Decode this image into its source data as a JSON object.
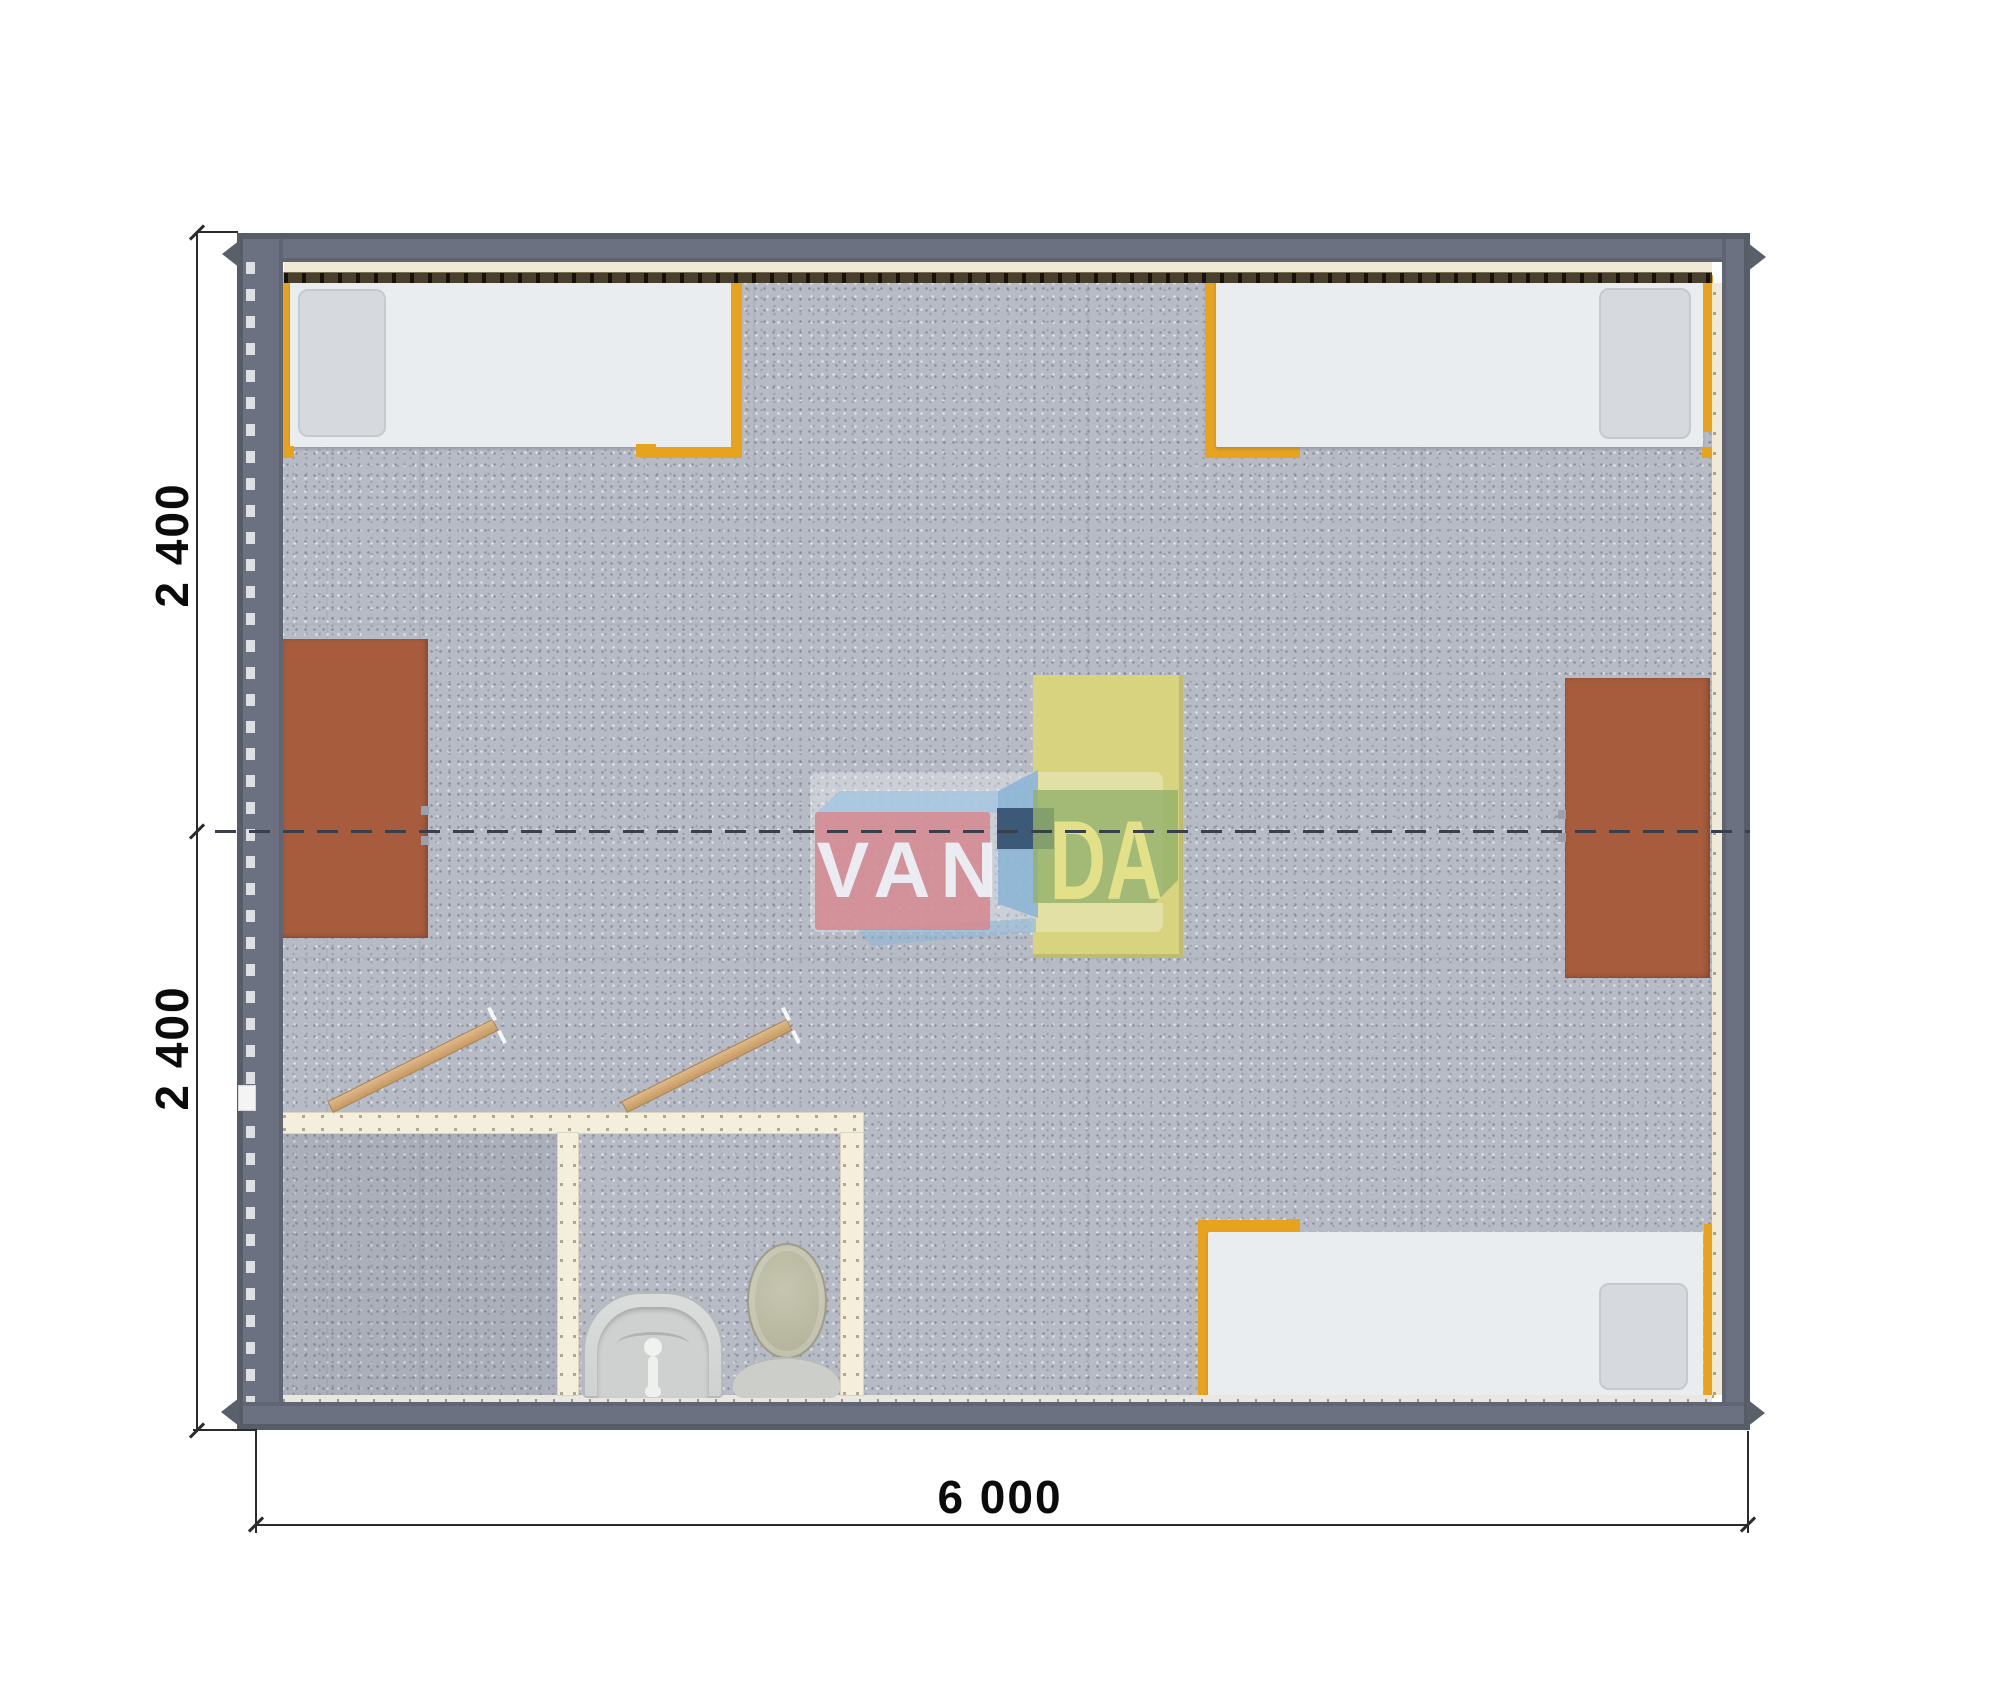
{
  "dimensions": {
    "left_top": "2 400",
    "left_bottom": "2 400",
    "bottom": "6 000",
    "building_width_mm": 6000,
    "module_depth_mm": 2400
  },
  "watermark": {
    "van": "VAN",
    "da": "DA"
  },
  "palette": {
    "wall_gray": "#6b7180",
    "wall_edge": "#575d66",
    "floor_carpet": "#b7bbc5",
    "bathroom_wall_cream": "#f4efdd",
    "bed_frame_orange": "#e7a31e",
    "mattress_white": "#eaedf0",
    "desk_brown": "#a65c3d",
    "table_yellow": "#d7d37f",
    "door_wood": "#d3a976",
    "logo_red": "#d48b94",
    "logo_blue": "#8cb5d5",
    "logo_green": "#92b06a",
    "logo_navy": "#365070",
    "module_joint_dash": "#3a404b"
  },
  "furniture": {
    "beds": 3,
    "desks": 2,
    "center_table": 1,
    "toilet": 1,
    "sink": 1,
    "doors": 2
  }
}
